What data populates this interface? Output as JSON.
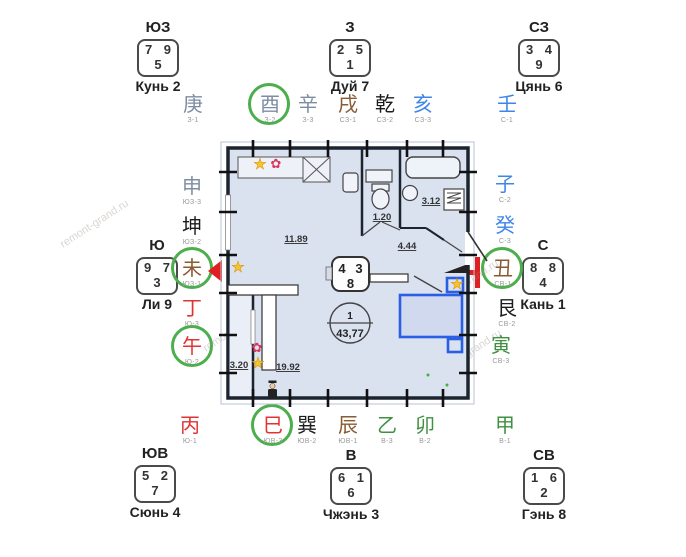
{
  "watermark": "remont-grand.ru",
  "palette": {
    "circle_green": "#4cae4c",
    "pointer_red": "#e02020",
    "furniture_blue": "#2b5fe3",
    "plan_fill": "#dae1ef",
    "wall_dark": "#1c2430",
    "element_metal": "#7e8da3",
    "element_earth": "#8a5a33",
    "element_black": "#1c1c1c",
    "element_water": "#3f86e8",
    "element_fire": "#e23333",
    "element_wood": "#3f9142"
  },
  "corners": [
    {
      "direction": "ЮЗ",
      "top_left": "7",
      "top_right": "9",
      "bottom": "5",
      "name": "Кунь 2"
    },
    {
      "direction": "З",
      "top_left": "2",
      "top_right": "5",
      "bottom": "1",
      "name": "Дуй 7"
    },
    {
      "direction": "СЗ",
      "top_left": "3",
      "top_right": "4",
      "bottom": "9",
      "name": "Цянь 6"
    },
    {
      "direction": "Ю",
      "top_left": "9",
      "top_right": "7",
      "bottom": "3",
      "name": "Ли 9"
    },
    {
      "direction": "С",
      "top_left": "8",
      "top_right": "8",
      "bottom": "4",
      "name": "Кань 1"
    },
    {
      "direction": "ЮВ",
      "top_left": "5",
      "top_right": "2",
      "bottom": "7",
      "name": "Сюнь 4"
    },
    {
      "direction": "В",
      "top_left": "6",
      "top_right": "1",
      "bottom": "6",
      "name": "Чжэнь 3"
    },
    {
      "direction": "СВ",
      "top_left": "1",
      "top_right": "6",
      "bottom": "2",
      "name": "Гэнь 8"
    }
  ],
  "mountains": [
    {
      "char": "庚",
      "label": "З-1",
      "element": "metal",
      "circled": false
    },
    {
      "char": "酉",
      "label": "З-2",
      "element": "metal",
      "circled": true
    },
    {
      "char": "辛",
      "label": "З-3",
      "element": "metal",
      "circled": false
    },
    {
      "char": "戌",
      "label": "СЗ-1",
      "element": "earth",
      "circled": false
    },
    {
      "char": "乾",
      "label": "СЗ-2",
      "element": "black",
      "circled": false
    },
    {
      "char": "亥",
      "label": "СЗ-3",
      "element": "water",
      "circled": false
    },
    {
      "char": "壬",
      "label": "С-1",
      "element": "water",
      "circled": false
    },
    {
      "char": "申",
      "label": "ЮЗ-3",
      "element": "metal",
      "circled": false
    },
    {
      "char": "坤",
      "label": "ЮЗ-2",
      "element": "black",
      "circled": false
    },
    {
      "char": "未",
      "label": "ЮЗ-1",
      "element": "earth",
      "circled": true
    },
    {
      "char": "丁",
      "label": "Ю-3",
      "element": "fire",
      "circled": false
    },
    {
      "char": "午",
      "label": "Ю-2",
      "element": "fire",
      "circled": true
    },
    {
      "char": "子",
      "label": "С-2",
      "element": "water",
      "circled": false
    },
    {
      "char": "癸",
      "label": "С-3",
      "element": "water",
      "circled": false
    },
    {
      "char": "丑",
      "label": "СВ-1",
      "element": "earth",
      "circled": true
    },
    {
      "char": "艮",
      "label": "СВ-2",
      "element": "black",
      "circled": false
    },
    {
      "char": "寅",
      "label": "СВ-3",
      "element": "wood",
      "circled": false
    },
    {
      "char": "丙",
      "label": "Ю-1",
      "element": "fire",
      "circled": false
    },
    {
      "char": "巳",
      "label": "ЮВ-3",
      "element": "fire",
      "circled": true
    },
    {
      "char": "巽",
      "label": "ЮВ-2",
      "element": "black",
      "circled": false
    },
    {
      "char": "辰",
      "label": "ЮВ-1",
      "element": "earth",
      "circled": false
    },
    {
      "char": "乙",
      "label": "В-3",
      "element": "wood",
      "circled": false
    },
    {
      "char": "卯",
      "label": "В-2",
      "element": "wood",
      "circled": false
    },
    {
      "char": "甲",
      "label": "В-1",
      "element": "wood",
      "circled": false
    }
  ],
  "plan": {
    "rooms": {
      "main": "11.89",
      "toilet": "1.20",
      "bath": "3.12",
      "hall": "4.44",
      "lower": "19.92",
      "balcony": "3.20"
    },
    "apartment": {
      "number": "1",
      "area": "43,77"
    },
    "center_box": {
      "top_left": "4",
      "top_right": "3",
      "bottom": "8"
    },
    "icons": [
      "star",
      "flower",
      "person"
    ]
  }
}
